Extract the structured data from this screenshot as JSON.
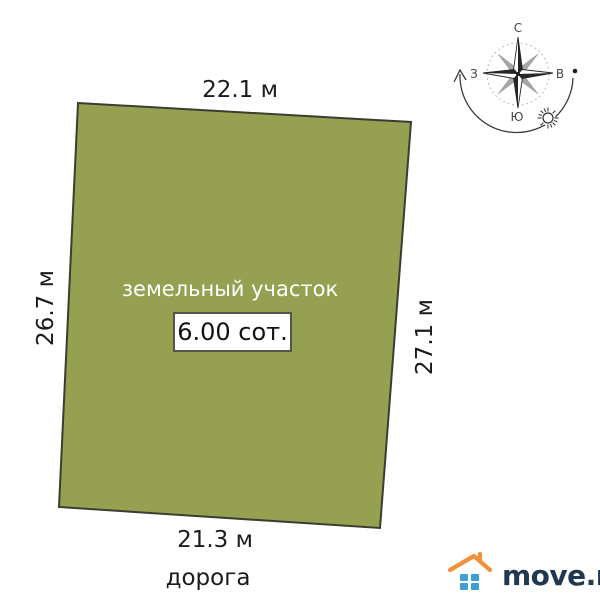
{
  "plot": {
    "label": "земельный участок",
    "area": "6.00 сот.",
    "dimensions": {
      "top": "22.1 м",
      "left": "26.7 м",
      "right": "27.1 м",
      "bottom": "21.3 м"
    },
    "road_label": "дорога",
    "fill_color": "#95a051"
  },
  "compass": {
    "north": "С",
    "east": "В",
    "south": "Ю",
    "west": "З"
  },
  "logo": {
    "text": "move.ru",
    "colors": {
      "roof": "#f0913a",
      "window": "#3e9ed8",
      "text": "#20394f"
    }
  }
}
